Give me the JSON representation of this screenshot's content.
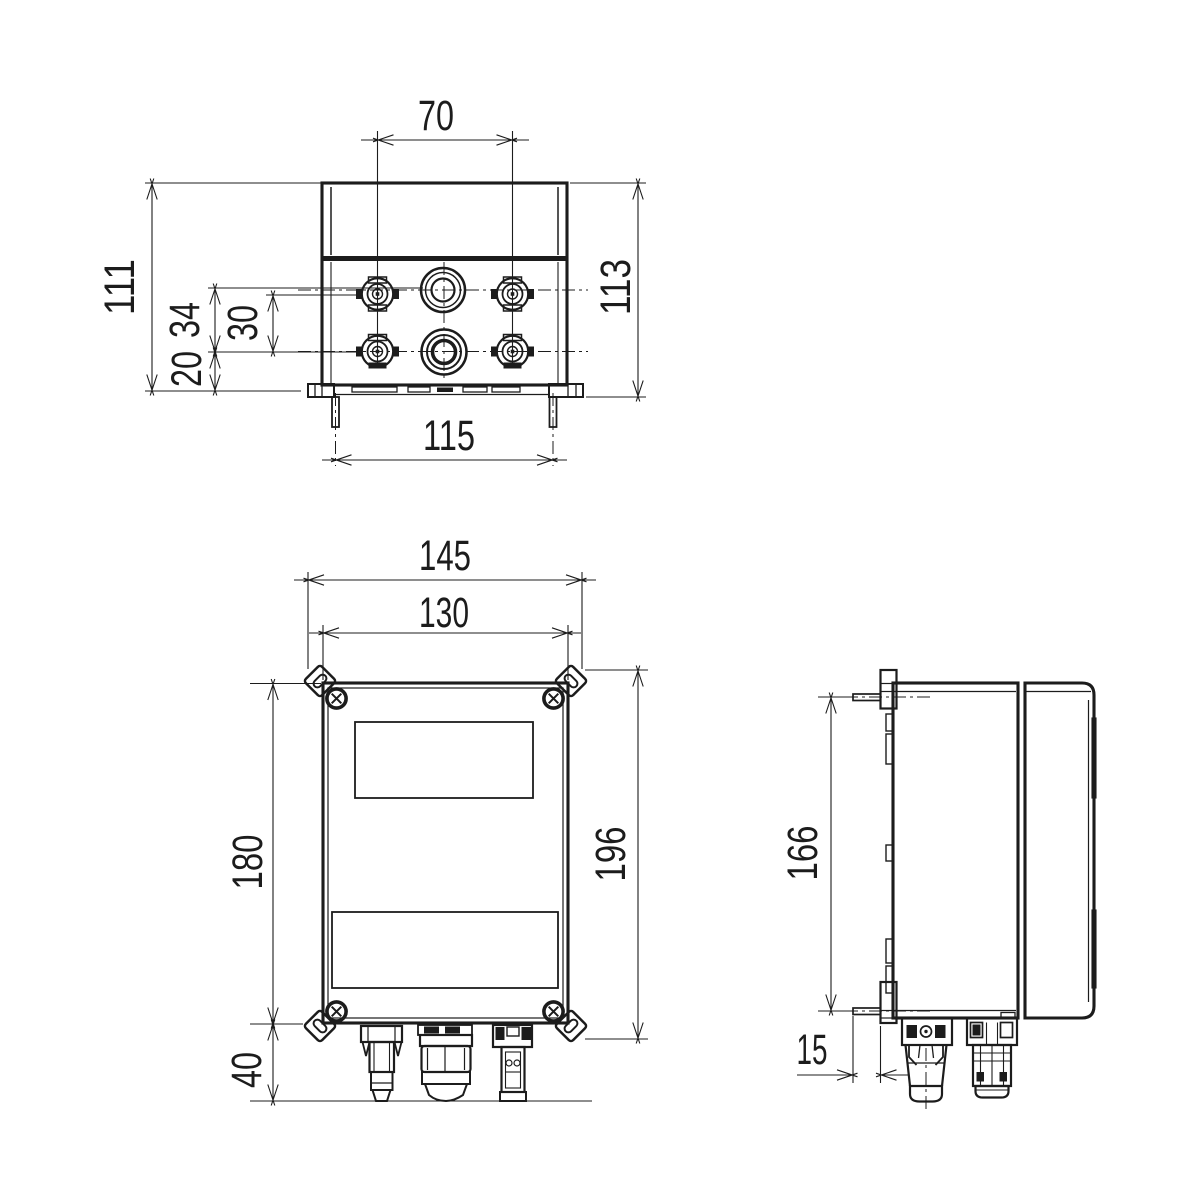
{
  "drawing": {
    "views": {
      "top_view": "top view",
      "front_view": "front view",
      "side_view": "side view"
    }
  },
  "dimensions": {
    "top_view": {
      "connector_column_spacing": "70",
      "overall_depth_left": "111",
      "gland_row_offset": "34",
      "connector_row_offset": "30",
      "base_offset": "20",
      "mounting_pin_spacing": "115",
      "overall_depth_right": "113"
    },
    "front_view": {
      "overall_width": "145",
      "enclosure_width": "130",
      "enclosure_height": "180",
      "overall_height": "196",
      "connector_protrusion": "40"
    },
    "side_view": {
      "mounting_hole_spacing": "166",
      "wall_standoff": "15"
    }
  },
  "colors": {
    "ink": "#1c1c1c",
    "paper": "#ffffff"
  }
}
